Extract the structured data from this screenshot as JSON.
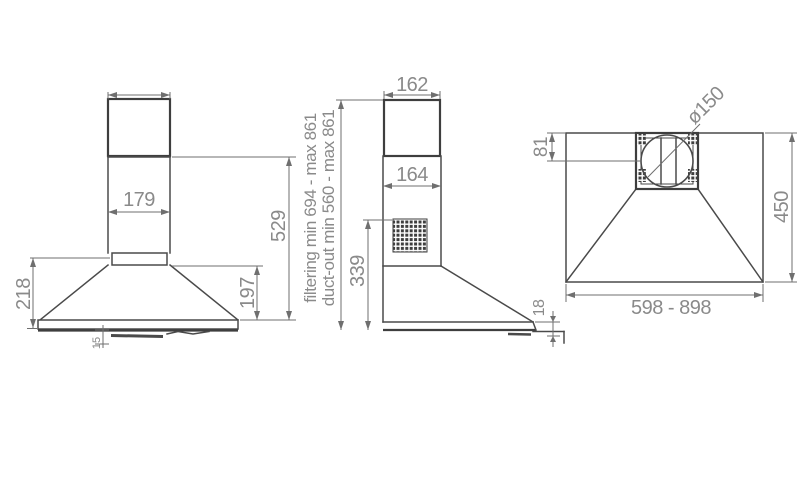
{
  "drawing": {
    "front": {
      "chimney_width": "179",
      "overall_height": "529",
      "hood_height": "218",
      "cone_height": "197",
      "lip_height": "15"
    },
    "side": {
      "chimney_top_depth": "162",
      "chimney_bottom_depth": "164",
      "body_height": "339",
      "base_edge_thickness": "18",
      "filtering_range": "filtering min 694 - max 861",
      "duct_out_range": "duct-out min 560 - max 861"
    },
    "top": {
      "duct_diameter": "ø150",
      "duct_offset": "81",
      "depth": "450",
      "width_range": "598 - 898"
    }
  },
  "colors": {
    "background": "#ffffff",
    "body_line": "#4a4a4a",
    "dim_line": "#6f6f6f",
    "dim_text": "#8a8a8a",
    "grille": "#3e3e3e"
  }
}
